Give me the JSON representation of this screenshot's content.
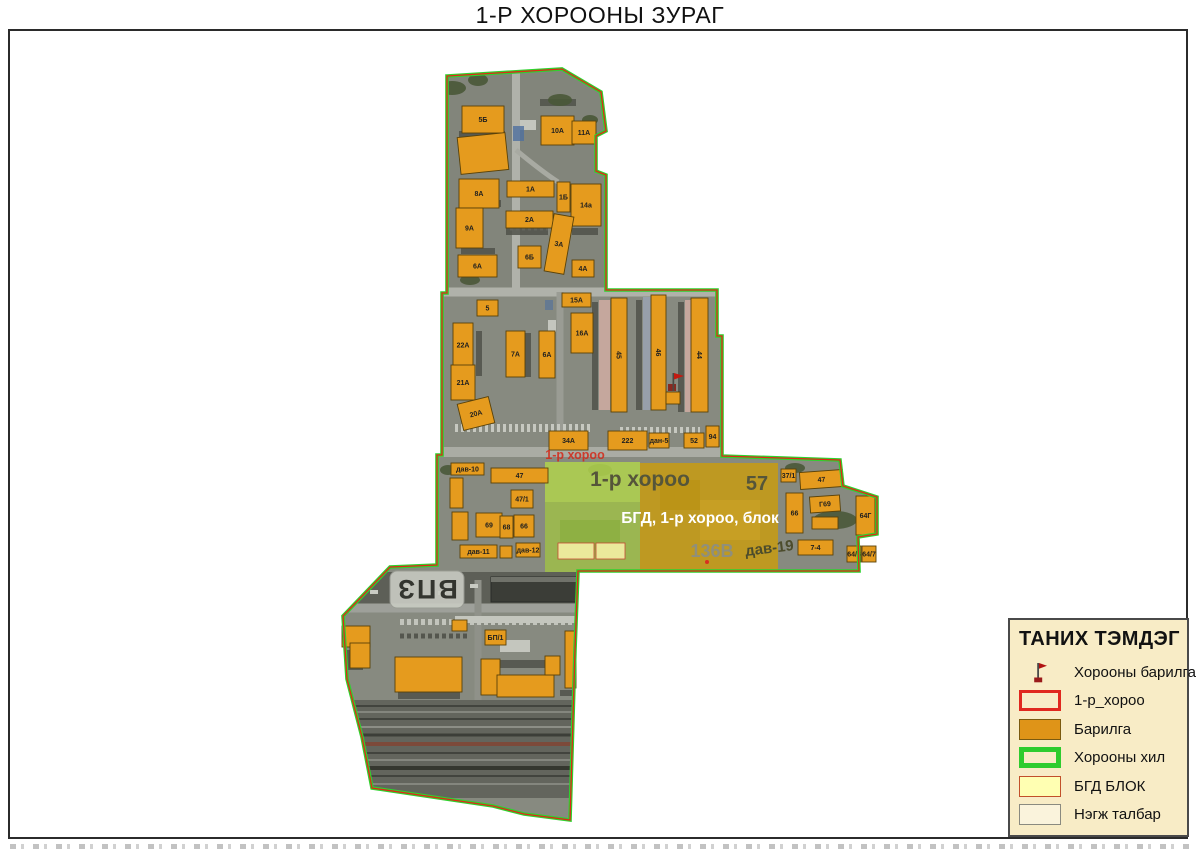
{
  "title": "1-Р ХОРООНЫ ЗУРАГ",
  "map": {
    "red_label": "1-р хороо",
    "rooftop_sign": "ВПЗ",
    "overlay": {
      "khoroo_label": "1-р хороо",
      "parcel_57": "57",
      "block_caption": "БГД, 1-р хороо, блок",
      "parcel_136": "136В",
      "parcel_dav19": "дав-19"
    },
    "buildings": [
      {
        "label": "5Б",
        "x": 462,
        "y": 106,
        "w": 42,
        "h": 27
      },
      {
        "label": "10А",
        "x": 541,
        "y": 116,
        "w": 33,
        "h": 29
      },
      {
        "label": "11А",
        "x": 572,
        "y": 121,
        "w": 24,
        "h": 23
      },
      {
        "label": "",
        "x": 459,
        "y": 135,
        "w": 48,
        "h": 37,
        "r": -6
      },
      {
        "label": "8А",
        "x": 459,
        "y": 179,
        "w": 40,
        "h": 29
      },
      {
        "label": "1А",
        "x": 507,
        "y": 181,
        "w": 47,
        "h": 16
      },
      {
        "label": "1Б",
        "x": 557,
        "y": 182,
        "w": 13,
        "h": 30
      },
      {
        "label": "14а",
        "x": 571,
        "y": 184,
        "w": 30,
        "h": 42
      },
      {
        "label": "9А",
        "x": 456,
        "y": 208,
        "w": 27,
        "h": 40
      },
      {
        "label": "2А",
        "x": 506,
        "y": 211,
        "w": 47,
        "h": 17
      },
      {
        "label": "3А",
        "x": 549,
        "y": 215,
        "w": 20,
        "h": 58,
        "r": 10
      },
      {
        "label": "6Б",
        "x": 518,
        "y": 246,
        "w": 23,
        "h": 22
      },
      {
        "label": "6А",
        "x": 458,
        "y": 255,
        "w": 39,
        "h": 22
      },
      {
        "label": "4А",
        "x": 572,
        "y": 260,
        "w": 22,
        "h": 17
      },
      {
        "label": "5",
        "x": 477,
        "y": 300,
        "w": 21,
        "h": 16
      },
      {
        "label": "15А",
        "x": 562,
        "y": 293,
        "w": 29,
        "h": 14
      },
      {
        "label": "22А",
        "x": 453,
        "y": 323,
        "w": 20,
        "h": 44
      },
      {
        "label": "7А",
        "x": 506,
        "y": 331,
        "w": 19,
        "h": 46
      },
      {
        "label": "6А",
        "x": 539,
        "y": 331,
        "w": 16,
        "h": 47
      },
      {
        "label": "16А",
        "x": 571,
        "y": 313,
        "w": 22,
        "h": 40
      },
      {
        "label": "21А",
        "x": 451,
        "y": 365,
        "w": 24,
        "h": 35
      },
      {
        "label": "20А",
        "x": 460,
        "y": 400,
        "w": 32,
        "h": 27,
        "r": -14
      },
      {
        "label": "45",
        "x": 611,
        "y": 298,
        "w": 16,
        "h": 114,
        "lr": 90
      },
      {
        "label": "46",
        "x": 651,
        "y": 295,
        "w": 15,
        "h": 115,
        "lr": 90
      },
      {
        "label": "44",
        "x": 691,
        "y": 298,
        "w": 17,
        "h": 114,
        "lr": 90
      },
      {
        "label": "34А",
        "x": 549,
        "y": 431,
        "w": 39,
        "h": 19
      },
      {
        "label": "222",
        "x": 608,
        "y": 431,
        "w": 39,
        "h": 19
      },
      {
        "label": "дан-5",
        "x": 649,
        "y": 433,
        "w": 20,
        "h": 15
      },
      {
        "label": "52",
        "x": 684,
        "y": 433,
        "w": 20,
        "h": 15
      },
      {
        "label": "94",
        "x": 706,
        "y": 426,
        "w": 13,
        "h": 21
      },
      {
        "label": "",
        "x": 666,
        "y": 392,
        "w": 14,
        "h": 12
      },
      {
        "label": "дав-10",
        "x": 451,
        "y": 463,
        "w": 33,
        "h": 12
      },
      {
        "label": "",
        "x": 450,
        "y": 478,
        "w": 13,
        "h": 30
      },
      {
        "label": "47",
        "x": 491,
        "y": 468,
        "w": 57,
        "h": 15
      },
      {
        "label": "47/1",
        "x": 511,
        "y": 490,
        "w": 22,
        "h": 18
      },
      {
        "label": "",
        "x": 452,
        "y": 512,
        "w": 16,
        "h": 28
      },
      {
        "label": "69",
        "x": 476,
        "y": 513,
        "w": 26,
        "h": 24
      },
      {
        "label": "68",
        "x": 500,
        "y": 516,
        "w": 13,
        "h": 22
      },
      {
        "label": "66",
        "x": 514,
        "y": 515,
        "w": 20,
        "h": 22
      },
      {
        "label": "дав-11",
        "x": 460,
        "y": 545,
        "w": 37,
        "h": 13
      },
      {
        "label": "",
        "x": 500,
        "y": 546,
        "w": 12,
        "h": 12
      },
      {
        "label": "дав-12",
        "x": 516,
        "y": 543,
        "w": 24,
        "h": 14
      },
      {
        "label": "37/1",
        "x": 781,
        "y": 469,
        "w": 15,
        "h": 13
      },
      {
        "label": "47",
        "x": 800,
        "y": 471,
        "w": 43,
        "h": 17,
        "r": -4
      },
      {
        "label": "66",
        "x": 786,
        "y": 493,
        "w": 17,
        "h": 40
      },
      {
        "label": "Г69",
        "x": 810,
        "y": 496,
        "w": 30,
        "h": 16,
        "r": -4
      },
      {
        "label": "",
        "x": 812,
        "y": 517,
        "w": 26,
        "h": 12
      },
      {
        "label": "64Г",
        "x": 856,
        "y": 496,
        "w": 19,
        "h": 39
      },
      {
        "label": "7-4",
        "x": 798,
        "y": 540,
        "w": 35,
        "h": 15
      },
      {
        "label": "64/6",
        "x": 847,
        "y": 546,
        "w": 14,
        "h": 16
      },
      {
        "label": "64/7",
        "x": 862,
        "y": 546,
        "w": 14,
        "h": 16
      },
      {
        "label": "",
        "x": 342,
        "y": 626,
        "w": 28,
        "h": 21
      },
      {
        "label": "",
        "x": 350,
        "y": 643,
        "w": 20,
        "h": 25
      },
      {
        "label": "БП/1",
        "x": 485,
        "y": 630,
        "w": 21,
        "h": 15
      },
      {
        "label": "",
        "x": 452,
        "y": 620,
        "w": 15,
        "h": 11
      },
      {
        "label": "",
        "x": 395,
        "y": 657,
        "w": 67,
        "h": 35
      },
      {
        "label": "",
        "x": 481,
        "y": 659,
        "w": 19,
        "h": 36
      },
      {
        "label": "",
        "x": 497,
        "y": 675,
        "w": 57,
        "h": 22
      },
      {
        "label": "",
        "x": 545,
        "y": 656,
        "w": 15,
        "h": 19
      },
      {
        "label": "",
        "x": 565,
        "y": 631,
        "w": 11,
        "h": 57
      }
    ]
  },
  "legend": {
    "title": "ТАНИХ ТЭМДЭГ",
    "items": [
      {
        "label": "Хорооны барилга",
        "swatch": "flag",
        "name": "khoroo-building"
      },
      {
        "label": "1-р_хороо",
        "swatch": "red-outline",
        "name": "khoroo-1"
      },
      {
        "label": "Барилга",
        "swatch": "orange-fill",
        "name": "barilga"
      },
      {
        "label": "Хорооны хил",
        "swatch": "green-outline",
        "name": "khoroo-border"
      },
      {
        "label": "БГД БЛОК",
        "swatch": "yellow-fill",
        "name": "bgd-block"
      },
      {
        "label": "Нэгж талбар",
        "swatch": "plain-fill",
        "name": "unit-parcel"
      }
    ]
  },
  "colors": {
    "building_fill": "#e59b1e",
    "building_stroke": "#5a4208",
    "border_green": "#2ed22e",
    "border_red": "#e02818",
    "overlay_green": "#a3c83e",
    "overlay_ochre": "#c49a17",
    "bgd_yellow": "#f0eda0",
    "legend_bg": "#f8ecc6"
  }
}
